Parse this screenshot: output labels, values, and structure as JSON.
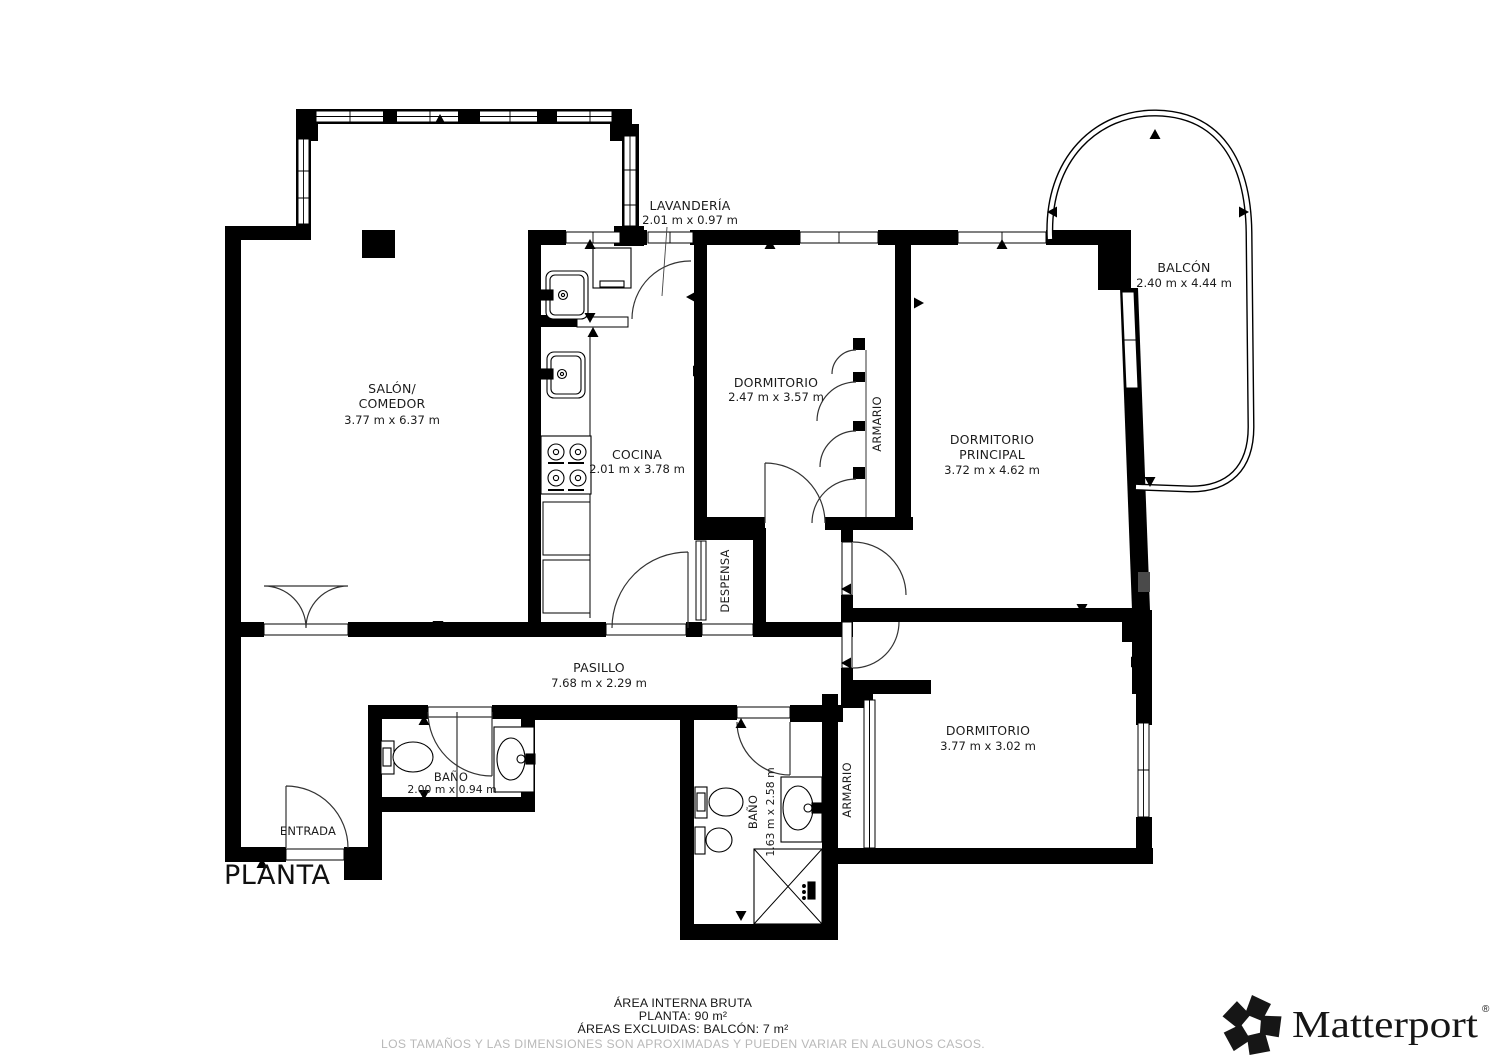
{
  "plan": {
    "title": "PLANTA",
    "rooms": {
      "salon": {
        "name1": "SALÓN/",
        "name2": "COMEDOR",
        "dims": "3.77 m x 6.37 m"
      },
      "lavanderia": {
        "name": "LAVANDERÍA",
        "dims": "2.01 m x 0.97 m"
      },
      "cocina": {
        "name": "COCINA",
        "dims": "2.01 m x 3.78 m"
      },
      "dormitorio": {
        "name": "DORMITORIO",
        "dims": "2.47 m x 3.57 m"
      },
      "armario_dormitorio": {
        "name": "ARMARIO"
      },
      "dormitorio_principal": {
        "name1": "DORMITORIO",
        "name2": "PRINCIPAL",
        "dims": "3.72 m x 4.62 m"
      },
      "balcon": {
        "name": "BALCÓN",
        "dims": "2.40 m x 4.44 m"
      },
      "despensa": {
        "name": "DESPENSA"
      },
      "pasillo": {
        "name": "PASILLO",
        "dims": "7.68 m x 2.29 m"
      },
      "bano_pasillo": {
        "name": "BAÑO",
        "dims": "2.00 m x 0.94 m"
      },
      "entrada": {
        "name": "ENTRADA"
      },
      "bano_grande": {
        "name": "BAÑO",
        "dims": "1.63 m x 2.58 m"
      },
      "armario_dormitorio_2": {
        "name": "ARMARIO"
      },
      "dormitorio_2": {
        "name": "DORMITORIO",
        "dims": "3.77 m x 3.02 m"
      }
    }
  },
  "footer": {
    "area_title": "ÁREA INTERNA BRUTA",
    "area_planta": "PLANTA: 90 m²",
    "area_excluded": "ÁREAS EXCLUIDAS: BALCÓN: 7 m²",
    "disclaimer": "LOS TAMAÑOS Y LAS DIMENSIONES SON APROXIMADAS Y PUEDEN VARIAR EN ALGUNOS CASOS."
  },
  "brand": {
    "wordmark": "Matterport",
    "registered_mark": "®"
  },
  "icons": {
    "brand_logo": "matterport-pinwheel-icon",
    "wall_marker": "direction-triangle-icon"
  },
  "colors": {
    "walls": "#000000",
    "label_text": "#1c1c1c",
    "disclaimer_text": "#b9b9b9",
    "shade": "#4a4a4a",
    "background": "#ffffff"
  }
}
